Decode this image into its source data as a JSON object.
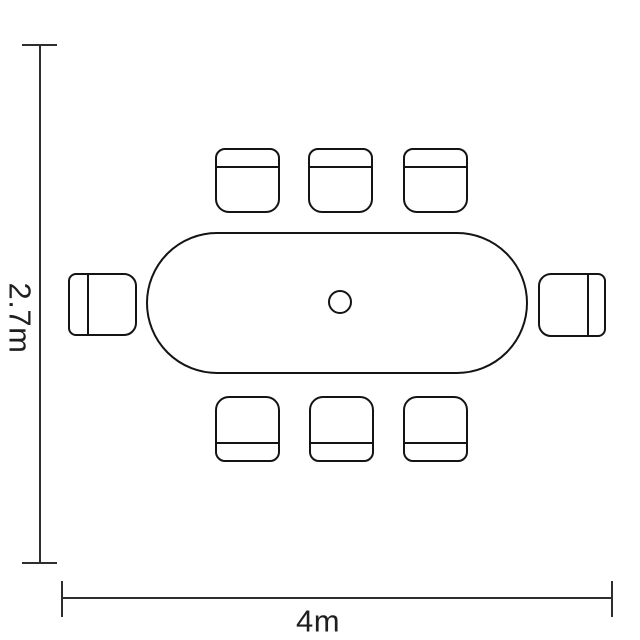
{
  "diagram": {
    "type": "dining-table-floor-plan",
    "colors": {
      "background": "#ffffff",
      "furniture_line": "#141414",
      "dimension_line": "#2e2e2e",
      "label_text": "#1f1f1f"
    },
    "dimensions": {
      "height_label": "2.7m",
      "width_label": "4m"
    },
    "furniture": {
      "table_shape": "oval-stadium",
      "table_detail": "center-circle",
      "chair_total": 8,
      "chairs_top": 3,
      "chairs_bottom": 3,
      "chairs_left": 1,
      "chairs_right": 1
    }
  }
}
